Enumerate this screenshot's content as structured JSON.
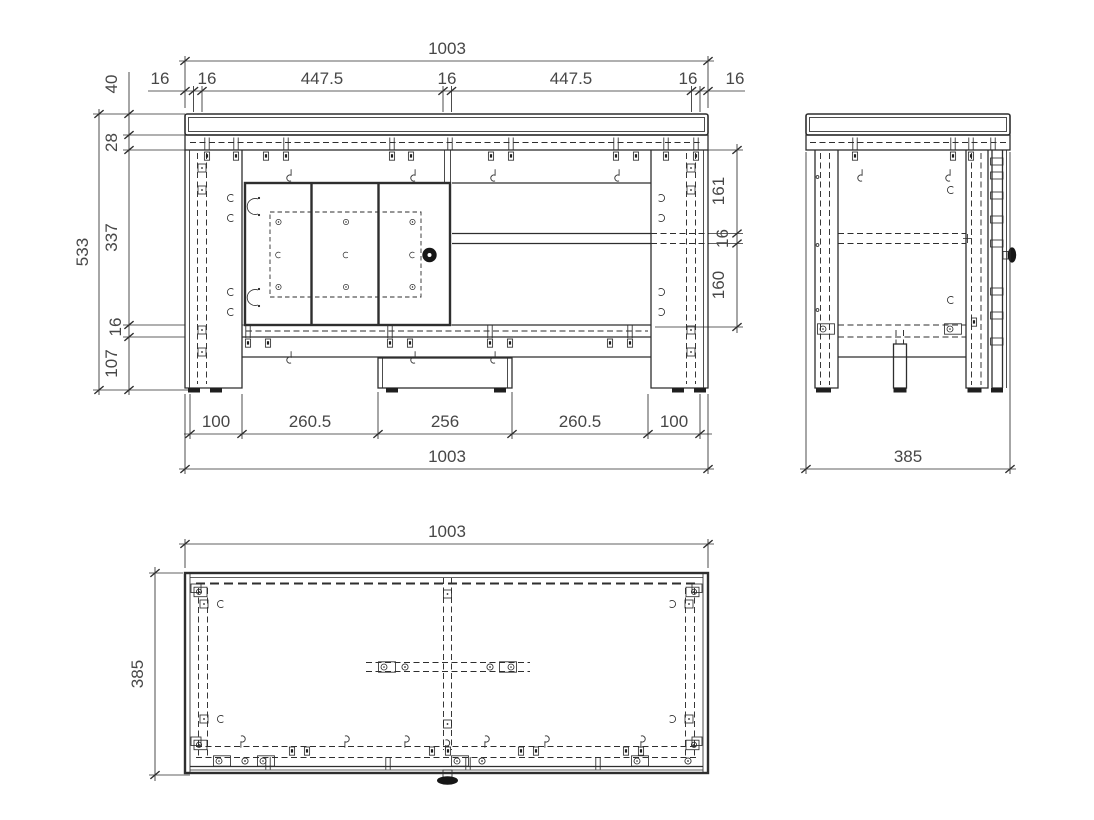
{
  "colors": {
    "line": "#2e2e2e",
    "text": "#474747",
    "background": "#ffffff",
    "dark_fill": "#1f1f1f"
  },
  "front": {
    "width_top": "1003",
    "top_chain": [
      "16",
      "16",
      "447.5",
      "16",
      "447.5",
      "16",
      "16"
    ],
    "height_overall": "533",
    "left_chain": [
      "40",
      "28",
      "337",
      "16",
      "107"
    ],
    "right_chain": [
      "161",
      "16",
      "160"
    ],
    "bottom_chain": [
      "100",
      "260.5",
      "256",
      "260.5",
      "100"
    ],
    "width_bottom": "1003"
  },
  "side": {
    "depth": "385"
  },
  "top": {
    "width": "1003",
    "depth": "385"
  }
}
